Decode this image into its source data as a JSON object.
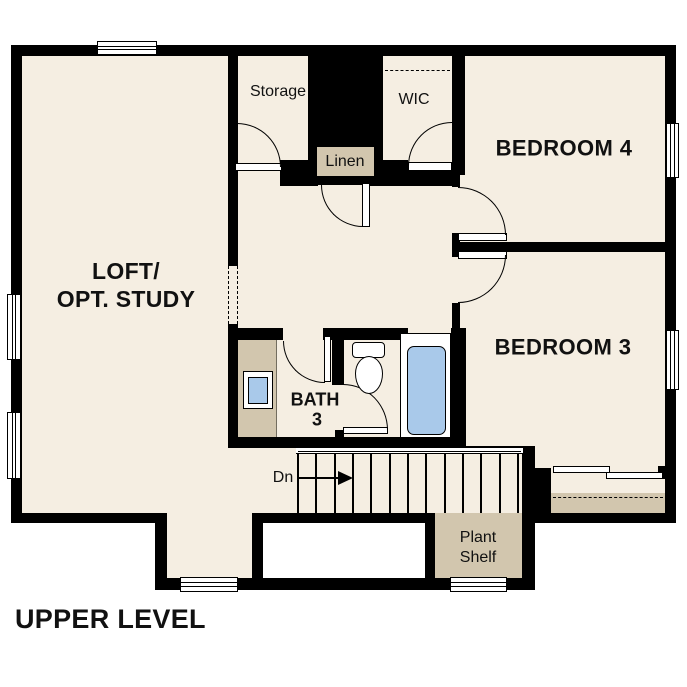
{
  "title": "UPPER LEVEL",
  "rooms": {
    "loft_line1": "LOFT/",
    "loft_line2": "OPT. STUDY",
    "bedroom4": "BEDROOM 4",
    "bedroom3": "BEDROOM 3",
    "bath_line1": "BATH",
    "bath_line2": "3",
    "storage": "Storage",
    "wic": "WIC",
    "linen": "Linen",
    "plant_shelf_line1": "Plant",
    "plant_shelf_line2": "Shelf",
    "stairs_direction": "Dn"
  },
  "colors": {
    "background": "#ffffff",
    "floor": "#f5eee2",
    "wall": "#000000",
    "millwork_tan": "#d2c6ae",
    "fixture_blue": "#a9c9ea",
    "text": "#111111"
  }
}
